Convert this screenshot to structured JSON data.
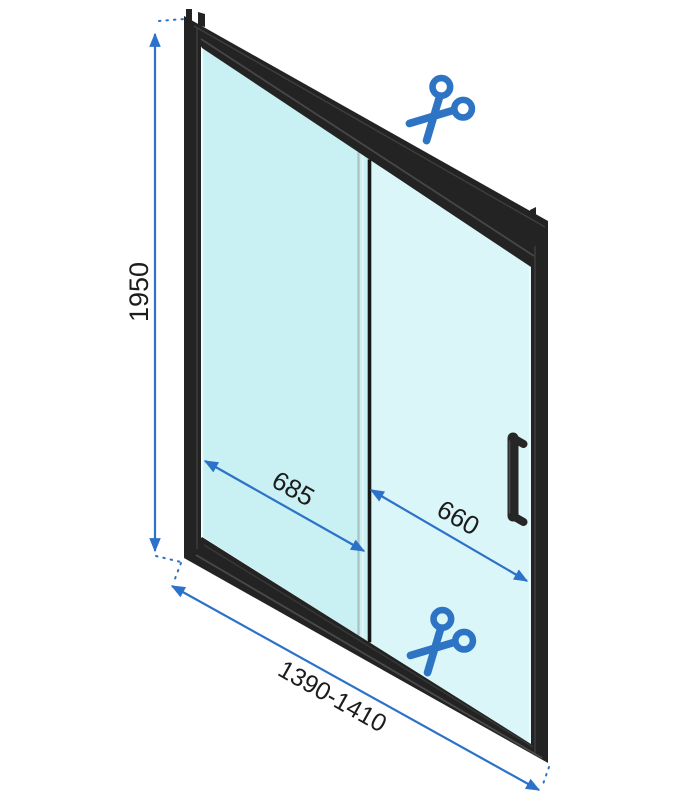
{
  "diagram": {
    "dimensions": {
      "height": "1950",
      "fixed_panel_width": "685",
      "door_panel_width": "660",
      "total_width_range": "1390-1410"
    },
    "icons": {
      "cut_mark_top": "scissors-icon",
      "cut_mark_bottom": "scissors-icon"
    },
    "colors": {
      "dimension_blue": "#2b72c8",
      "scissors_blue": "#2e74c4",
      "frame_black": "#232323",
      "glass_fixed": "#c9f0f2",
      "glass_sliding": "#dbf6f8"
    }
  }
}
